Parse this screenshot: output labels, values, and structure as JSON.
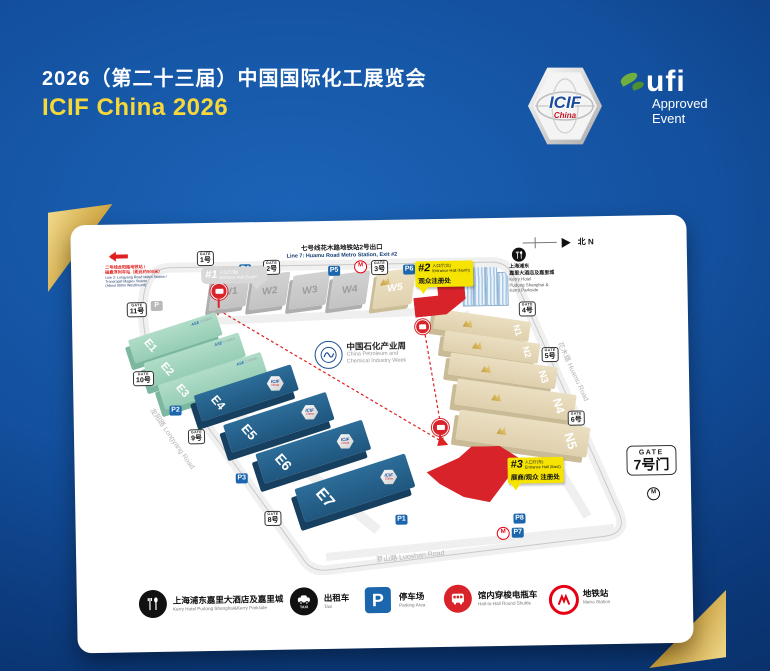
{
  "header": {
    "title_cn": "2026（第二十三届）中国国际化工展览会",
    "title_en": "ICIF China 2026",
    "icif_badge": {
      "title": "ICIF",
      "sub": "China"
    },
    "ufi": {
      "brand": "ufi",
      "line1": "Approved",
      "line2": "Event"
    }
  },
  "map": {
    "compass": "北 N",
    "metro_line7": {
      "cn": "七号线花木路地铁站2号出口",
      "en": "Line 7: Huamu Road Metro Station, Exit #2"
    },
    "metro_line2": {
      "cn1": "二号线龙阳路地铁站 /",
      "cn2": "磁悬浮列车站（距此约900米）",
      "en1": "Line 2: Longyang Road Metro Station /",
      "en2": "Transrapid Maglev Station",
      "en3": "(About 900m Westbound)"
    },
    "entrance1": {
      "num": "#1",
      "cn": "入口厅(南)",
      "en": "Entrance Hall (South)"
    },
    "entrance2": {
      "num": "#2",
      "cn": "入口厅(北)",
      "en": "Entrance Hall (North)",
      "reg": "观众注册处"
    },
    "entrance3": {
      "num": "#3",
      "cn": "入口厅(东)",
      "en": "Entrance Hall (East)",
      "reg": "展商/观众 注册处"
    },
    "hotel": {
      "cn1": "上海浦东",
      "cn2": "嘉里大酒店及嘉里城",
      "en1": "Kerry Hotel",
      "en2": "Pudong Shanghai &",
      "en3": "Kerry Parkside"
    },
    "center_logo": {
      "cn": "中国石化产业周",
      "en1": "China Petroleum and",
      "en2": "Chemical Industry Week"
    },
    "roads": {
      "longyang": "龙阳路  Longyang Road",
      "huamu": "花木路  Huamu Road",
      "luoshan": "罗山路  Luoshan Road"
    },
    "halls": {
      "w": [
        "W1",
        "W2",
        "W3",
        "W4",
        "W5"
      ],
      "e": [
        "E1",
        "E2",
        "E3",
        "E4",
        "E5",
        "E6",
        "E7"
      ],
      "n": [
        "N1",
        "N2",
        "N3",
        "N4",
        "N5"
      ]
    },
    "ase": {
      "b": "ASE",
      "rest": "CHINA"
    },
    "badge": {
      "title": "ICIF",
      "sub": "China"
    },
    "gates": {
      "word": "GATE",
      "g1": "1号",
      "g2": "2号",
      "g3": "3号",
      "g4": "4号",
      "g5": "5号",
      "g6": "6号",
      "g7": "7号门",
      "g8": "8号",
      "g9": "9号",
      "g10": "10号",
      "g11": "11号"
    },
    "parking": {
      "p1": "P1",
      "p2": "P2",
      "p3": "P3",
      "p4": "P4",
      "p5": "P5",
      "p6": "P6",
      "p7": "P7",
      "p8": "P8",
      "p_plain": "P"
    },
    "metro_m": "M"
  },
  "legend": {
    "items": [
      {
        "cn": "上海浦东嘉里大酒店及嘉里城",
        "en": "Kerry Hotel Pudong Shanghai&Kerry Parkside"
      },
      {
        "cn": "出租车",
        "en": "Taxi"
      },
      {
        "cn": "停车场",
        "en": "Parking Area"
      },
      {
        "cn": "馆内穿梭电瓶车",
        "en": "Hall-to-Hall Round Shuttle"
      },
      {
        "cn": "地铁站",
        "en": "Metro Station"
      }
    ],
    "taxi_text": "TAXI",
    "p_letter": "P"
  },
  "colors": {
    "bg_navy": "#082c61",
    "bg_blue": "#1c64b8",
    "title_yellow": "#f7d83a",
    "hall_blue": "#25608c",
    "hall_green": "#a5d6c0",
    "hall_tan": "#e7dabc",
    "hall_gray": "#cbcbcb",
    "entrance_red": "#d8232a",
    "callout_yellow": "#f6e400",
    "metro_red": "#e60012",
    "parking_blue": "#1b66ad",
    "gold": "#d4aa4a",
    "ufi_green": "#6fae3f"
  }
}
